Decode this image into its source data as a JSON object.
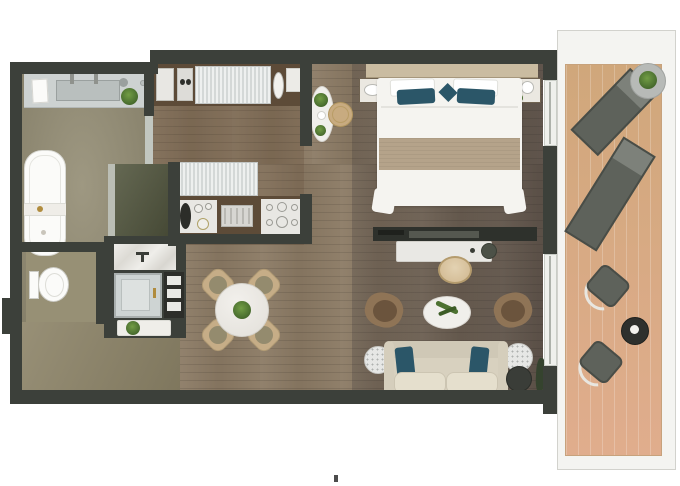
{
  "scene": "residential-suite-floor-plan-top-view",
  "palette": {
    "wall": "#3c403a",
    "bath_floor": "#8e876d",
    "toilet_floor": "#979075",
    "corridor_floor": "#8d8468",
    "wood_floor": "#8b7a64",
    "closet": "#53573f",
    "glass": "#c2c7c0",
    "vanity": "#cdd2d1",
    "sink": "#b9bfbe",
    "white_fixture": "#fbfbf9",
    "tray": "#efede8",
    "gold": "#b08c3e",
    "teal": "#2b5668",
    "headboard": "#cabca1",
    "runner": "#b5a38a",
    "bed_white": "#f5f4f0",
    "chair_tan": "#c6ad87",
    "chair_seat": "#948b6e",
    "armchair": "#8f7456",
    "armchair_seat": "#6b543d",
    "sofa_body": "#d8d1bf",
    "sofa_cushion": "#e5dfcd",
    "speckle": "#aeb1af",
    "plant": "#4d7231",
    "tv_dark": "#2e312c",
    "desk_white": "#e9e8e4",
    "pouf": "#3a3d38",
    "deck_top": "#d0a77b",
    "deck_bottom": "#e0ad8d",
    "balcony_white": "#f4f4f1",
    "balcony_line": "#d2d2cd",
    "lounger": "#5e625b",
    "lounger_light": "#7d817a",
    "lounger_trim": "#494d47",
    "console_wood": "#5d4b38",
    "counter_panel": "#e8e7e3",
    "ribbed_a": "#eef0ef",
    "ribbed_b": "#d4d8d7",
    "dark_table": "#2e302d",
    "stool_tan": "#c8ab80",
    "nook_white": "#f0efeb"
  },
  "rooms": [
    {
      "name": "bathroom",
      "items": [
        "vanity-double-sink",
        "faucets-x2",
        "tissue-box",
        "potted-plant",
        "bathtub",
        "bath-tray"
      ]
    },
    {
      "name": "walk-in-wardrobe",
      "items": [
        "wardrobe-panel",
        "glass-partition"
      ]
    },
    {
      "name": "shower-room",
      "items": [
        "marble-shower",
        "shower-fixture",
        "glass-shower-enclosure",
        "towel-shelf-x3",
        "bench",
        "potted-plant"
      ]
    },
    {
      "name": "wc",
      "items": [
        "toilet"
      ]
    },
    {
      "name": "entry-hall",
      "items": []
    },
    {
      "name": "kitchen",
      "items": [
        "upper-console",
        "coffee-machine",
        "ribbed-cabinet-x2",
        "oval-sink",
        "lower-counter",
        "vessel-sink",
        "cooktop",
        "burner-hob"
      ]
    },
    {
      "name": "breakfast-nook",
      "items": [
        "oval-side-table",
        "rattan-stool",
        "potted-plants-x2"
      ]
    },
    {
      "name": "dining-area",
      "items": [
        "round-dining-table",
        "dining-chair-x4",
        "centerpiece-plant"
      ]
    },
    {
      "name": "bedroom",
      "items": [
        "headboard",
        "double-bed",
        "white-pillow-x2",
        "teal-accent-pillow-x3",
        "bed-runner",
        "nightstand-x2",
        "table-lamp-x2",
        "nightstand-plant"
      ]
    },
    {
      "name": "living-area",
      "items": [
        "tv-console",
        "desk",
        "desk-accessories",
        "desk-chair",
        "armchair-x2",
        "oval-coffee-table",
        "sofa",
        "teal-sofa-pillow-x2",
        "seat-cushion-x2",
        "marble-side-table-x2",
        "pouf",
        "floor-plant"
      ]
    },
    {
      "name": "balcony",
      "items": [
        "sun-lounger-x2",
        "round-table-with-plant",
        "outdoor-chair-x2",
        "small-round-table",
        "sliding-door-x2"
      ]
    }
  ]
}
